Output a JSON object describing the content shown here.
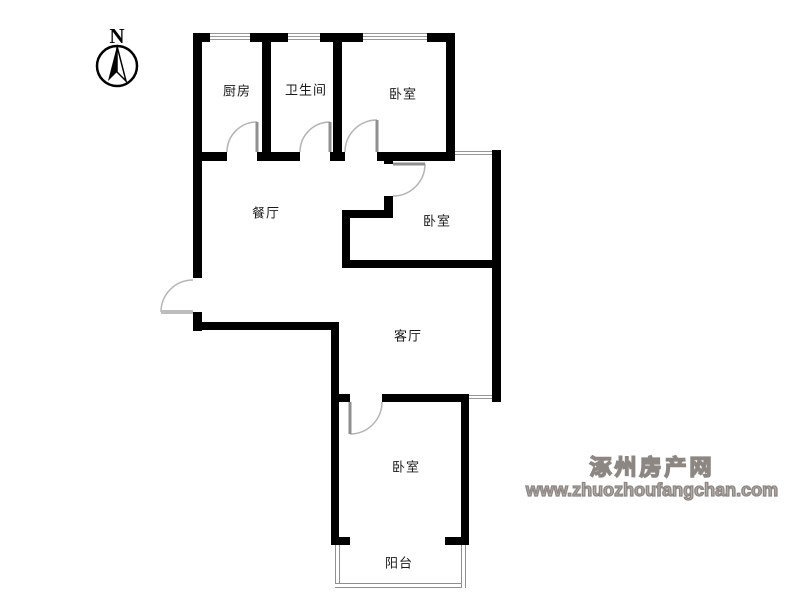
{
  "compass": {
    "label": "N"
  },
  "rooms": {
    "kitchen": {
      "label": "厨房"
    },
    "bathroom": {
      "label": "卫生间"
    },
    "bedroom_top": {
      "label": "卧室"
    },
    "dining": {
      "label": "餐厅"
    },
    "bedroom_middle": {
      "label": "卧室"
    },
    "living": {
      "label": "客厅"
    },
    "bedroom_bottom": {
      "label": "卧室"
    },
    "balcony": {
      "label": "阳台"
    }
  },
  "watermark": {
    "site_name": "涿州房产网",
    "site_url": "www.zhuozhoufangchan.com"
  },
  "colors": {
    "wall": "#000000",
    "door_arc": "#b4b4b4",
    "door_leaf": "#8f8f8f",
    "window_line": "#979797",
    "room_label": "#1a1a1a",
    "watermark": "#8d8783",
    "background": "#ffffff"
  }
}
